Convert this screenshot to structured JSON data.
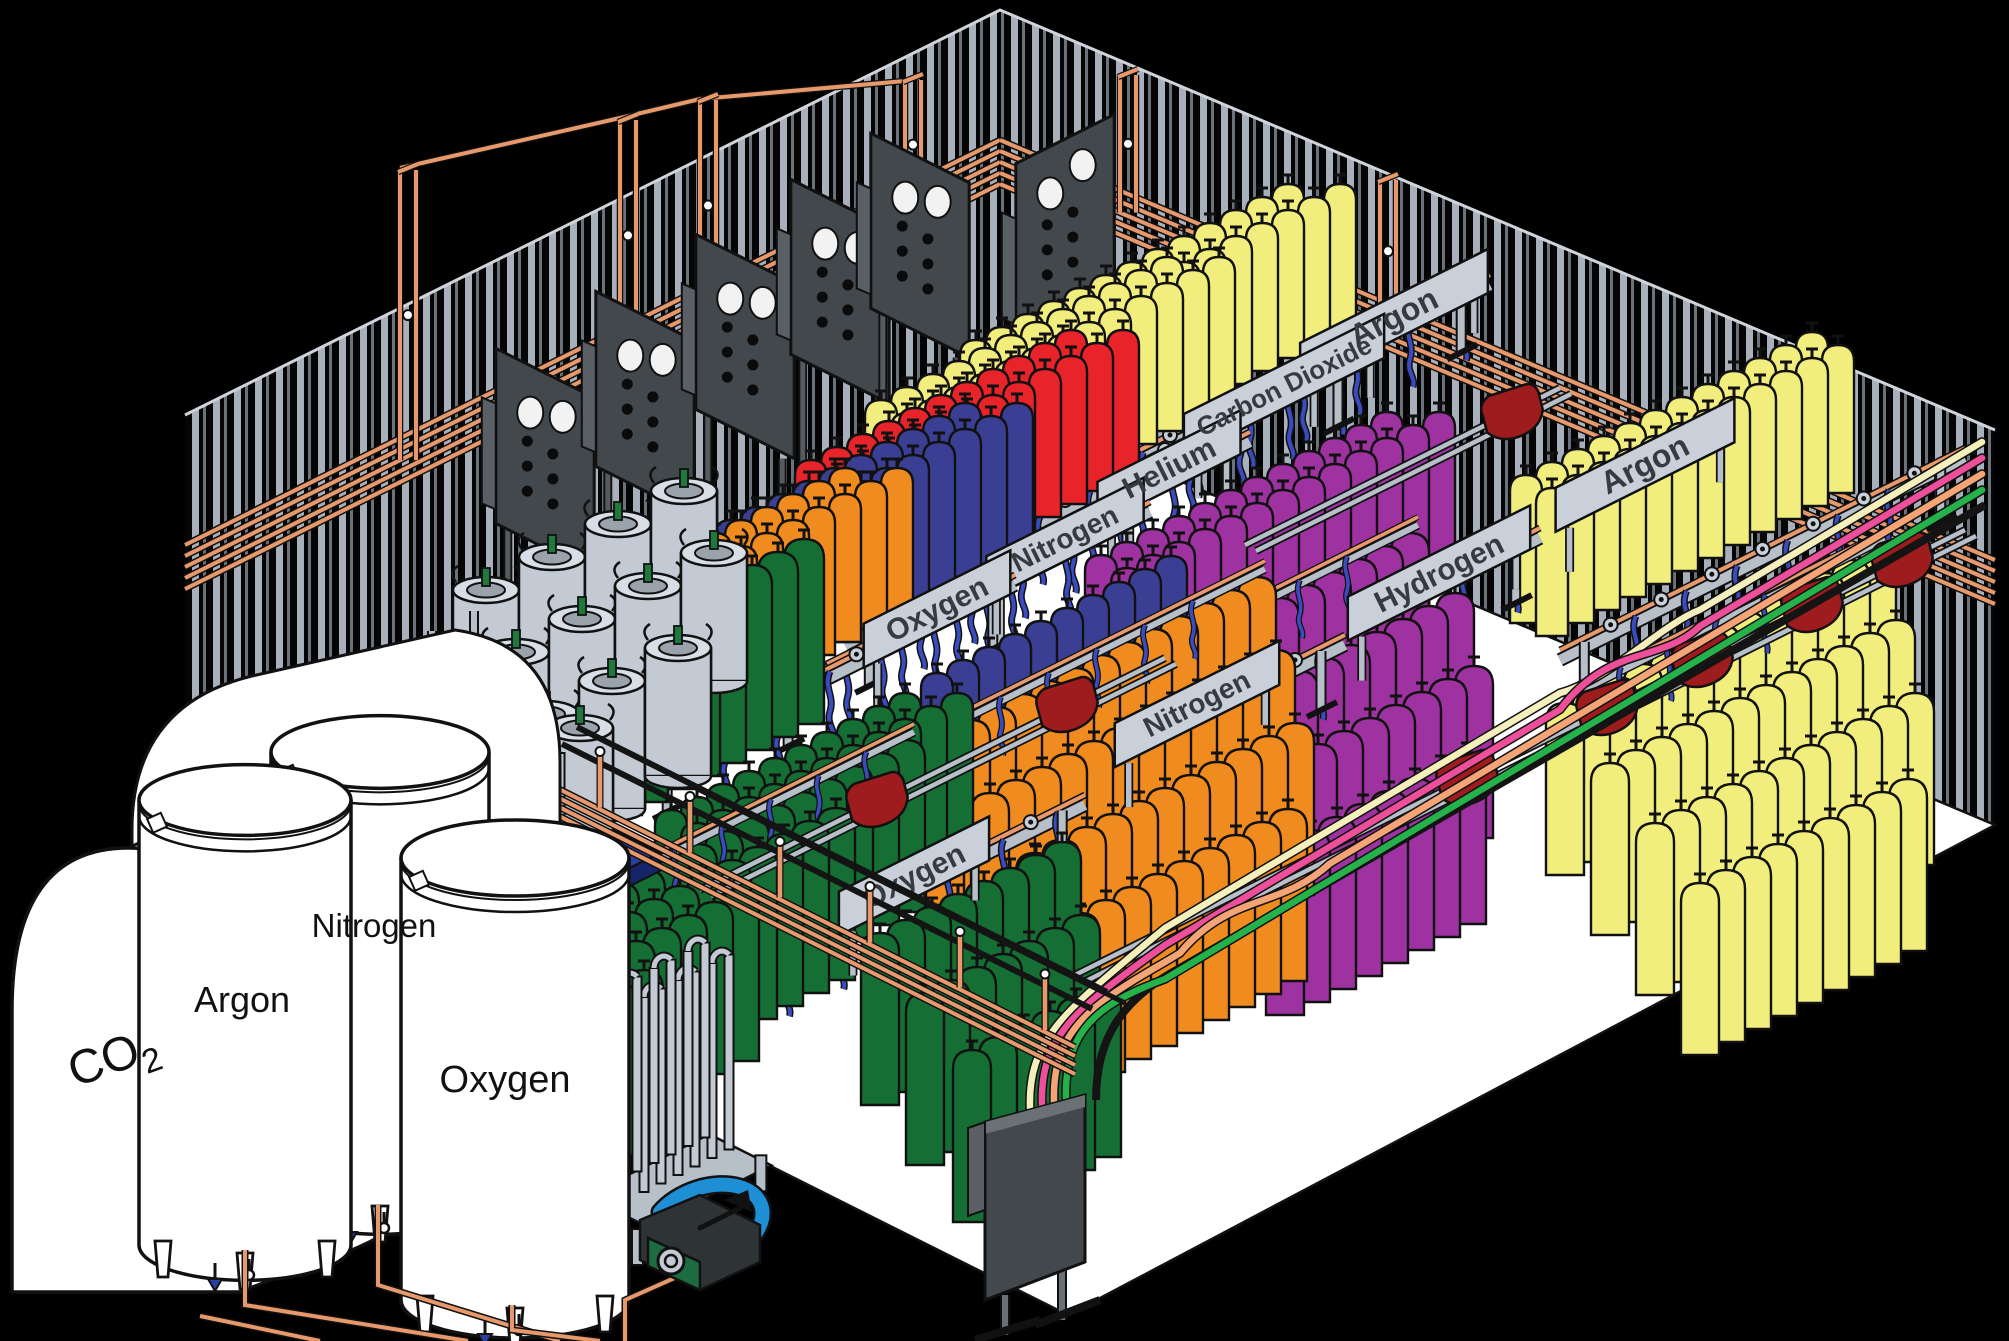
{
  "diagram": {
    "description": "Isometric cutaway illustration of an industrial gas cylinder filling plant",
    "storage_tanks": [
      {
        "id": "co2",
        "label": "CO2",
        "label_main": "CO",
        "label_sub": "2",
        "form": "horizontal tank"
      },
      {
        "id": "argon",
        "label": "Argon",
        "form": "vertical cryogenic tank"
      },
      {
        "id": "nitrogen",
        "label": "Nitrogen",
        "form": "vertical cryogenic tank"
      },
      {
        "id": "oxygen",
        "label": "Oxygen",
        "form": "vertical cryogenic tank"
      }
    ],
    "filling_bays": [
      {
        "id": "argon-1",
        "label": "Argon",
        "cylinder_colors": [
          "#f2ee7d"
        ]
      },
      {
        "id": "carbon-dioxide",
        "label": "Carbon Dioxide",
        "cylinder_colors": [
          "#f2ee7d"
        ]
      },
      {
        "id": "helium",
        "label": "Helium",
        "cylinder_colors": [
          "#e8242a"
        ]
      },
      {
        "id": "nitrogen-1",
        "label": "Nitrogen",
        "cylinder_colors": [
          "#3a3f94"
        ]
      },
      {
        "id": "oxygen-1",
        "label": "Oxygen",
        "cylinder_colors": [
          "#ef8b1f",
          "#156f35"
        ]
      },
      {
        "id": "argon-2",
        "label": "Argon",
        "cylinder_colors": [
          "#f2ee7d"
        ]
      },
      {
        "id": "hydrogen",
        "label": "Hydrogen",
        "cylinder_colors": [
          "#9e32a0"
        ]
      },
      {
        "id": "nitrogen-2",
        "label": "Nitrogen",
        "cylinder_colors": [
          "#3a3f94",
          "#ef8b1f"
        ]
      },
      {
        "id": "oxygen-2",
        "label": "Oxygen",
        "cylinder_colors": [
          "#156f35"
        ]
      }
    ],
    "colors": {
      "background": "#000000",
      "floor": "#ffffff",
      "wall_stripe_light": "#a8b0bc",
      "wall_stripe_dark": "#6a727c",
      "copper_pipe": "#e8996c",
      "yellow_hose": "#f2d028",
      "blue_hose": "#3b4cc0",
      "sign_plate": "#c9d0da",
      "rail_gray": "#b7bfc9",
      "panel_dark": "#42484c",
      "dewar_gray": "#c3cad4",
      "pallet_blue": "#2a3fa0",
      "cart_red": "#9e1b1e",
      "line_cream": "#f5f0bb",
      "line_pink": "#ee4f9b",
      "line_orange": "#f4a475",
      "line_green": "#25b24b",
      "pump_blue": "#1e8fd5",
      "pump_green": "#1d6b40",
      "valve_red": "#d93030"
    }
  }
}
